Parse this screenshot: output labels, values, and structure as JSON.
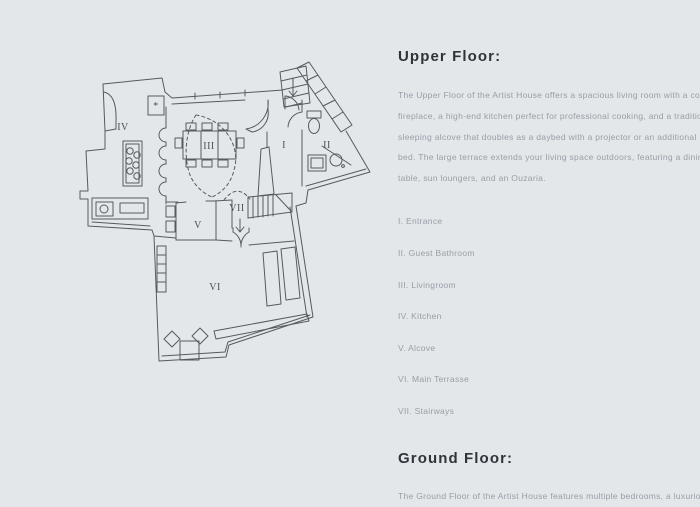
{
  "page": {
    "background_color": "#e4e7ea"
  },
  "floor_plan": {
    "stroke_color": "#565a60",
    "room_labels": {
      "kitchen": "IV",
      "livingroom": "III",
      "entrance": "I",
      "guest_bathroom": "II",
      "alcove": "V",
      "stairways": "VII",
      "main_terrasse": "VI",
      "column_marker": "*"
    }
  },
  "upper_floor": {
    "heading": "Upper Floor:",
    "description_lines": [
      "The Upper Floor of the Artist House offers a spacious living room with a cozy",
      "fireplace, a high-end kitchen perfect for professional cooking, and a traditional",
      "sleeping alcove that doubles as a daybed with a projector or an additional",
      "bed. The large terrace extends your living space outdoors, featuring a dining",
      "table, sun loungers, and an Ouzaria."
    ],
    "legend": [
      "I. Entrance",
      "II. Guest Bathroom",
      "III. Livingroom",
      "IV. Kitchen",
      "V. Alcove",
      "VI. Main Terrasse",
      "VII. Stairways"
    ]
  },
  "ground_floor": {
    "heading": "Ground Floor:",
    "description_lines": [
      "The Ground Floor of the Artist House features multiple bedrooms, a luxurious"
    ]
  }
}
